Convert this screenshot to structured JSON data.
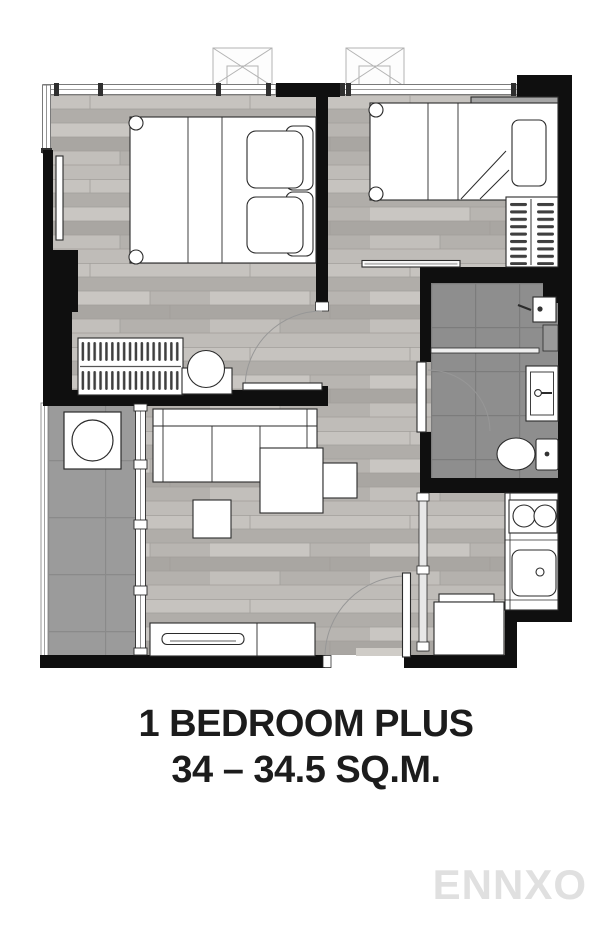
{
  "plan_title": {
    "line1": "1 BEDROOM PLUS",
    "line2": "34 – 34.5 SQ.M."
  },
  "watermark": "ENNXO",
  "colors": {
    "wall": "#0f0f0f",
    "wood_floor": "#bcb9b5",
    "bathroom_tile": "#8e8e8e",
    "balcony_tile": "#9b9b9b",
    "furniture_outline": "#2b2b2b",
    "title_text": "#1c1c1c",
    "watermark_gray": "#e0e0e0"
  }
}
